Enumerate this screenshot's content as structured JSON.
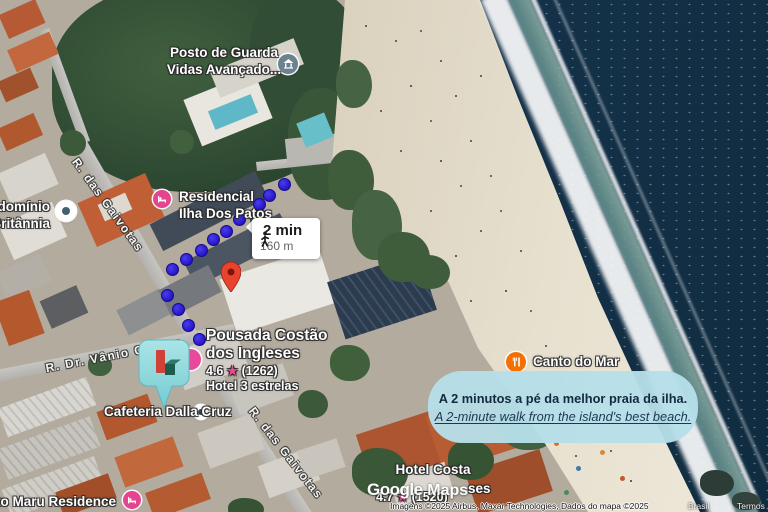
{
  "route": {
    "duration": "2 min",
    "distance": "160 m"
  },
  "annotation": {
    "line_pt": "A 2 minutos a pé da melhor praia da ilha.",
    "line_en": "A 2-minute walk from the island's best beach."
  },
  "streets": {
    "gaivotas_top": "R. das Gaivotas",
    "gaivotas_bottom": "R. das Gaivotas",
    "vanio_colaco": "R. Dr. Vânio Colaço"
  },
  "pois": {
    "posto": {
      "line1": "Posto de Guarda",
      "line2": "Vidas Avançado..."
    },
    "britannia": {
      "line1": "ndomínio",
      "line2": "Britânnia"
    },
    "residencial": {
      "line1": "Residencial",
      "line2": "Ilha Dos Patos"
    },
    "pousada": {
      "line1": "Pousada Costão",
      "line2": "dos Ingleses",
      "rating": "4.6",
      "star": "★",
      "reviews": "(1262)",
      "category": "Hotel 3 estrelas"
    },
    "cafeteria": {
      "name": "Cafeteria Dalla Cruz"
    },
    "canto_do_mar": {
      "name": "Canto do Mar"
    },
    "hotel_costa": {
      "line1": "Hotel Costa",
      "line2_fragment": "ses",
      "rating": "4.7",
      "star": "★",
      "reviews": "(1520)"
    },
    "misato": {
      "name": "sato Maru Residence"
    }
  },
  "watermark": {
    "brand": "Google",
    "product": "Maps"
  },
  "attribution": {
    "imagery": "Imagens ©2025 Airbus, Maxar Technologies, Dados do mapa ©2025",
    "region": "Brasil",
    "terms": "Termos"
  },
  "colors": {
    "lodging_pink": "#e5458f",
    "restaurant_orange": "#f57000",
    "route_blue": "#2d1cd8",
    "bubble_blue": "#b6dfe9",
    "pin_red": "#e8432e",
    "marker_teal": "#8ed7da"
  }
}
